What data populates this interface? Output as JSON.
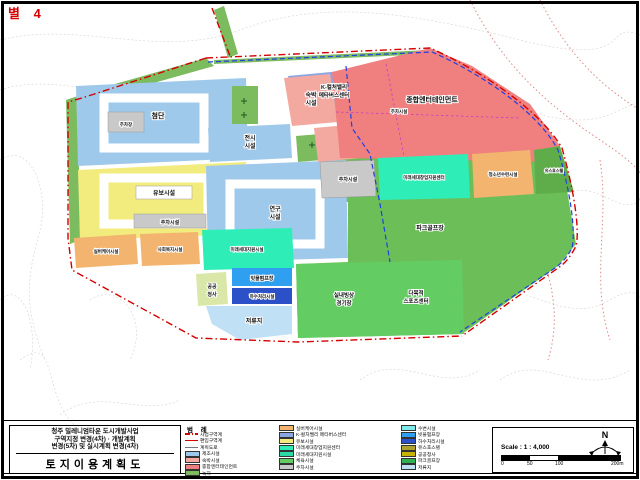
{
  "stamp": {
    "text": "별 4"
  },
  "title_block": {
    "line1": "청주 밀레니엄타운 도시개발사업",
    "line2": "구역지정 변경(4차) · 개발계획",
    "line3": "변경(5차) 및 실시계획 변경(4차)",
    "title": "토지이용계획도"
  },
  "zones": {
    "mfg": {
      "label": "첨단",
      "color": "#9FC9EA"
    },
    "parking_top": {
      "label": "주차장",
      "color": "#C9C9C9"
    },
    "reserve": {
      "label": "유보시설",
      "color": "#F2EC7E"
    },
    "parking_reserve": {
      "label": "주차시설",
      "color": "#C9C9C9"
    },
    "kvalley": {
      "label": "K-컬처밸리",
      "label2": "메타버스센터",
      "color": "#8BA7E3"
    },
    "parking_k": {
      "label": "주차시설",
      "color": "#C9C9C9"
    },
    "exhibition": {
      "label": "전시",
      "label2": "시설",
      "color": "#9FC9EA"
    },
    "research": {
      "label": "연구",
      "label2": "시설",
      "color": "#9FC9EA"
    },
    "lodging": {
      "label": "숙박",
      "label2": "시설",
      "color": "#F3A9A0"
    },
    "entertainment": {
      "label": "종합엔터테인먼트",
      "color": "#F08080"
    },
    "parking_mid": {
      "label": "주차시설",
      "color": "#C9C9C9"
    },
    "future_center": {
      "label": "미래세대창업지원센터",
      "color": "#2FEDB7"
    },
    "youth": {
      "label": "청소년수련시설",
      "color": "#F2B46E"
    },
    "hostel": {
      "label": "유스호스텔",
      "color": "#5FAD4A"
    },
    "sports_park": {
      "label": "파크골프장",
      "color": "#6CBE58"
    },
    "silver1": {
      "label": "실버케어시설",
      "color": "#F2B46E"
    },
    "silver2": {
      "label": "사회복지시설",
      "color": "#F2B46E"
    },
    "future_support": {
      "label": "미래세대지원시설",
      "color": "#2FEDB7"
    },
    "city_hall": {
      "label": "공공",
      "label2": "청사",
      "color": "#D9E8A8"
    },
    "pump_rain": {
      "label": "빗물펌프장",
      "color": "#2F9FF0"
    },
    "pump_sewage": {
      "label": "하수처리시설",
      "color": "#2B50C8"
    },
    "basin": {
      "label": "저류지",
      "color": "#BFE0F5"
    },
    "ice_rink": {
      "label": "실내빙상",
      "label2": "경기장",
      "color": "#63CD63"
    },
    "sports_center": {
      "label": "다목적",
      "label2": "스포츠센터",
      "color": "#63CD63"
    },
    "green_strip": {
      "color": "#7CBB5E"
    }
  },
  "legend": {
    "header": "범 례",
    "col1": [
      {
        "type": "dashdot",
        "color": "#D40000",
        "label": "사업구역계"
      },
      {
        "type": "line",
        "color": "#D40000",
        "label": "편입구역계"
      },
      {
        "type": "gray",
        "color": "#777777",
        "label": "계획도로"
      },
      {
        "type": "swatch",
        "color": "#9FC9EA",
        "label": "제조시설"
      },
      {
        "type": "swatch",
        "color": "#F3A9A0",
        "label": "숙박시설"
      },
      {
        "type": "swatch",
        "color": "#F08080",
        "label": "종합엔터테인먼트"
      },
      {
        "type": "swatch",
        "color": "#7CBB5E",
        "label": "녹지"
      }
    ],
    "col2": [
      {
        "color": "#F2B46E",
        "label": "실버케어시설"
      },
      {
        "color": "#8BA7E3",
        "label": "K-컬처밸리 메타버스센터"
      },
      {
        "color": "#F2EC7E",
        "label": "유보시설"
      },
      {
        "color": "#2FEDB7",
        "label": "미래세대창업지원센터"
      },
      {
        "color": "#2BD8A8",
        "label": "미래세대지원시설"
      },
      {
        "color": "#63CD63",
        "label": "체육시설"
      },
      {
        "color": "#C9C9C9",
        "label": "주차시설"
      }
    ],
    "col3": [
      {
        "color": "#7FE9E9",
        "label": "수변시설"
      },
      {
        "color": "#2F9FF0",
        "label": "빗물펌프장"
      },
      {
        "color": "#2B50C8",
        "label": "하수처리시설"
      },
      {
        "color": "#B0A030",
        "label": "유스호스텔"
      },
      {
        "color": "#C8B400",
        "label": "공공청사"
      },
      {
        "color": "#30B050",
        "label": "파크골프장"
      },
      {
        "color": "#BFE0F5",
        "label": "저류지"
      }
    ]
  },
  "scale_box": {
    "north": "N",
    "scale_label": "Scale : 1 : 4,000",
    "ticks": [
      "0",
      "50",
      "100",
      "200m"
    ]
  },
  "colors": {
    "boundary_red": "#D40000",
    "boundary_blue": "#2040E0",
    "contour_gray": "#CFCFCF",
    "topo_red": "#DD8888"
  }
}
